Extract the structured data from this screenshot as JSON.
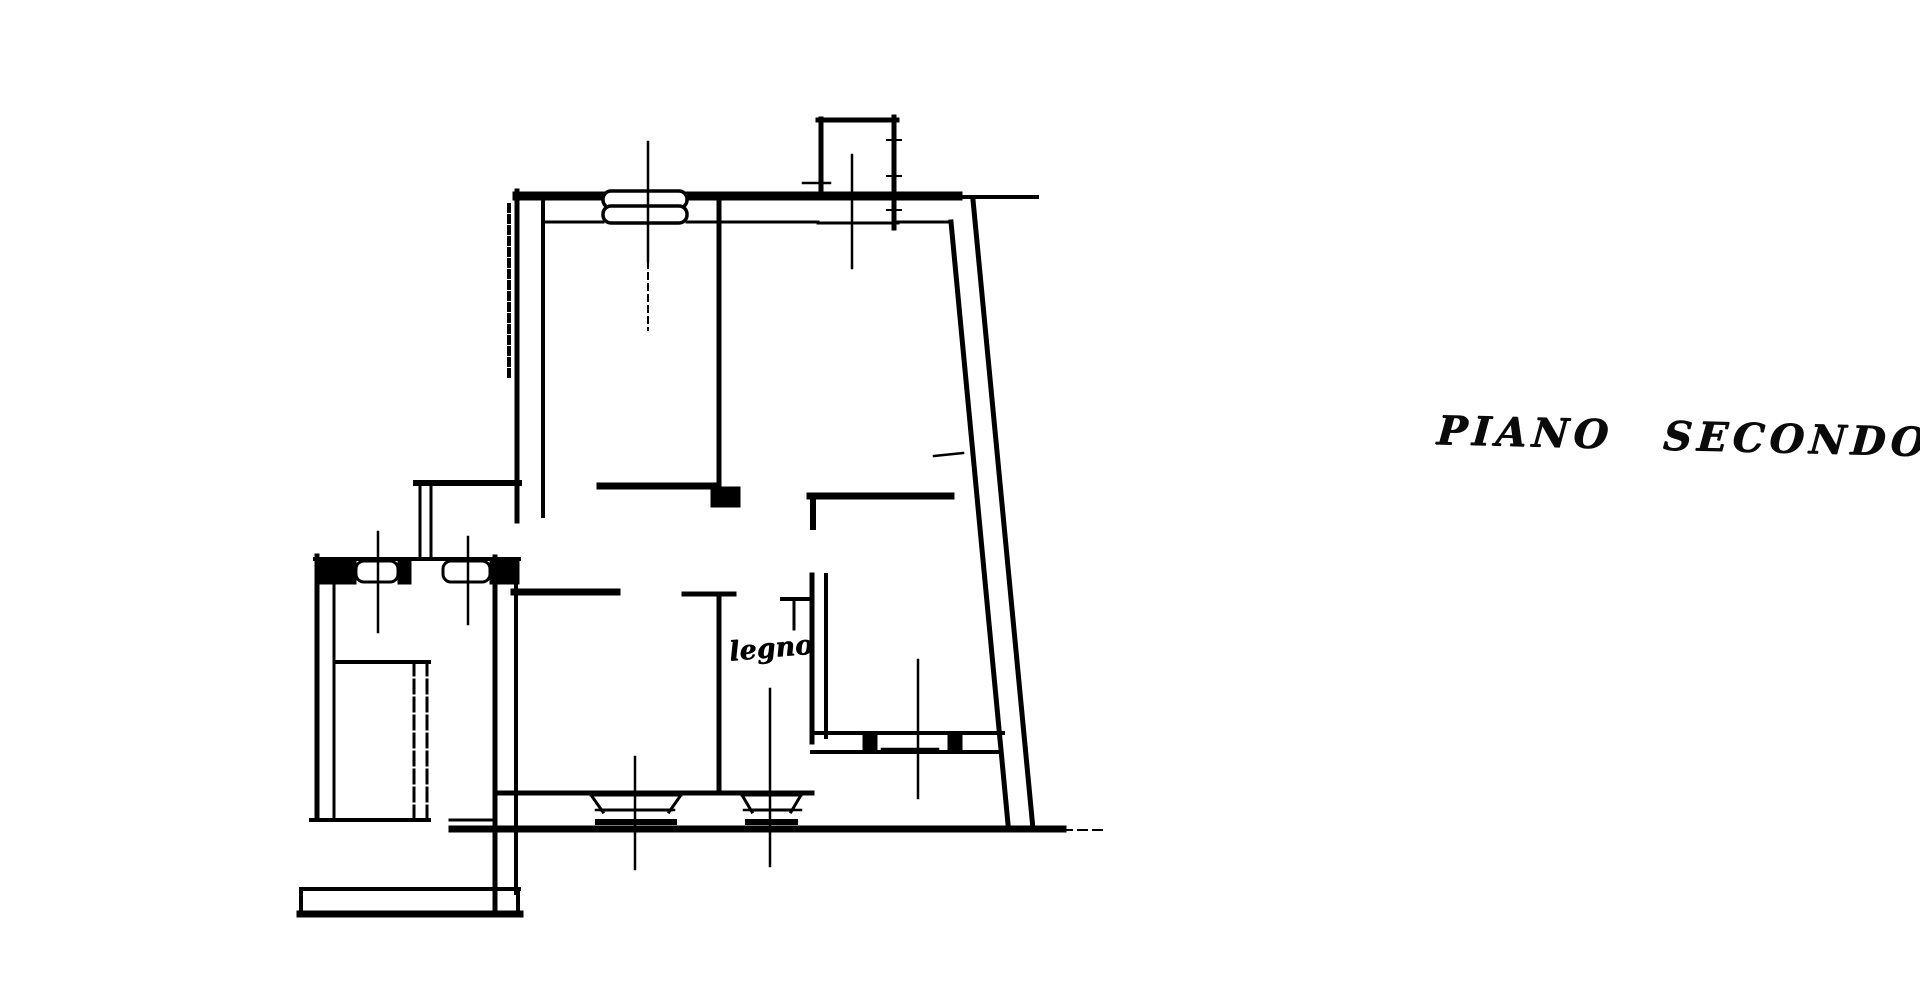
{
  "page": {
    "background_color": "#ffffff",
    "ink_color": "#000000",
    "kind": "scanned hand-drawn architectural floor plan"
  },
  "title": {
    "full": "PIANO SECONDO",
    "word1": "PIANO",
    "word2": "SECONDO"
  },
  "plan": {
    "annotation_label": "legno",
    "features": [
      "top-exterior-wall",
      "left-exterior-wall-hatched",
      "slanted-right-exterior-wall",
      "bottom-exterior-wall",
      "top-window-double-casement",
      "top-projection-bay",
      "interior-partition-walls",
      "corridor-band",
      "lower-left-room",
      "lower-middle-room-legno",
      "lower-right-room-with-window",
      "bottom-french-windows",
      "left-balcony-with-railing",
      "balcony-stair-divider",
      "axis-center-lines"
    ]
  }
}
